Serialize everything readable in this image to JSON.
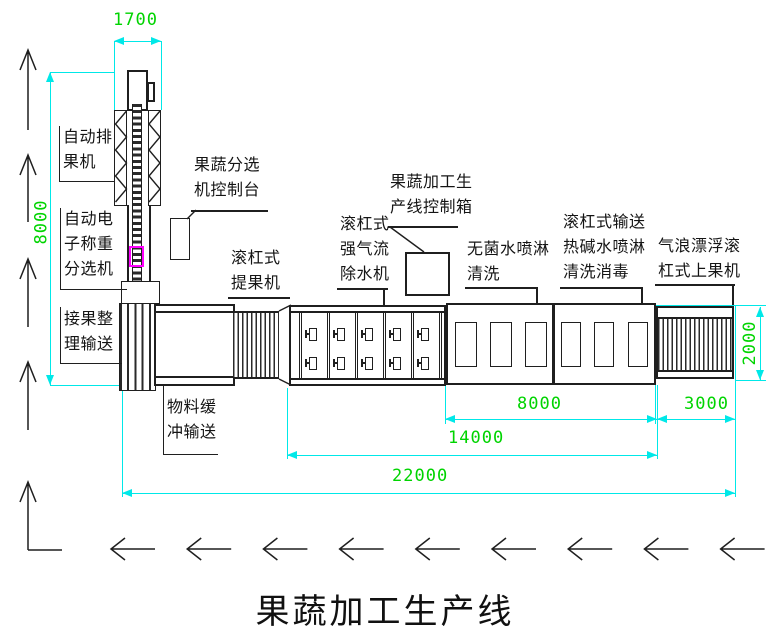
{
  "title": "果蔬加工生产线",
  "colors": {
    "dimension_line": "#00e8e8",
    "dimension_text": "#00d400",
    "structure": "#1f1f1f",
    "highlight": "#ff00ff"
  },
  "dimensions": {
    "top_width": "1700",
    "left_height": "8000",
    "right_height": "2000",
    "wash_span": "8000",
    "loader_span": "3000",
    "mid_span": "14000",
    "total_span": "22000"
  },
  "labels": {
    "auto_arrange": {
      "lines": [
        "自动排",
        "果机"
      ]
    },
    "auto_weigh_sort": {
      "lines": [
        "自动电",
        "子称重",
        "分选机"
      ]
    },
    "receive_convey": {
      "lines": [
        "接果整",
        "理输送"
      ]
    },
    "buffer_convey": {
      "lines": [
        "物料缓",
        "冲输送"
      ]
    },
    "sorter_console": {
      "lines": [
        "果蔬分选",
        "机控制台"
      ]
    },
    "roller_lifter": {
      "lines": [
        "滚杠式",
        "提果机"
      ]
    },
    "airflow_dewater": {
      "lines": [
        "滚杠式",
        "强气流",
        "除水机"
      ]
    },
    "line_control_box": {
      "lines": [
        "果蔬加工生",
        "产线控制箱"
      ]
    },
    "sterile_spray": {
      "lines": [
        "无菌水喷淋",
        "清洗"
      ]
    },
    "alkali_spray": {
      "lines": [
        "滚杠式输送",
        "热碱水喷淋",
        "清洗消毒"
      ]
    },
    "air_float_loader": {
      "lines": [
        "气浪漂浮滚",
        "杠式上果机"
      ]
    }
  },
  "figure": {
    "dewater_cells": 6,
    "dewater_rows": 2,
    "up_arrows": 5,
    "flow_arrows": 9
  }
}
